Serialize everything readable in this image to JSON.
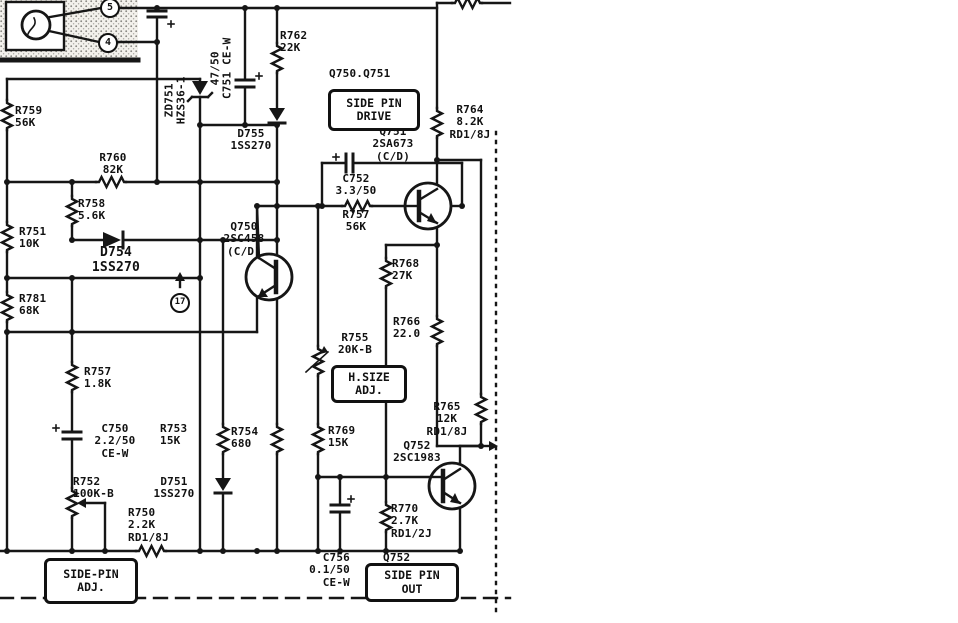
{
  "labels": {
    "r759": "R759\n56K",
    "r760": "R760\n82K",
    "r758": "R758\n5.6K",
    "r751": "R751\n10K",
    "d754": "D754\n1SS270",
    "r781": "R781\n68K",
    "r757_left": "R757\n1.8K",
    "c750": "C750\n2.2/50\nCE-W",
    "r752": "R752\n100K-B",
    "r750": "R750\n2.2K\nRD1/8J",
    "r753": "R753\n15K",
    "d751": "D751\n1SS270",
    "r754": "R754\n680",
    "r769": "R769\n15K",
    "c756": "C756\n0.1/50\nCE-W",
    "zd751": "ZD751\nHZS36-1",
    "c751": "47/50\nC751 CE-W",
    "r762": "R762\n22K",
    "d755": "D755\n1SS270",
    "q750": "Q750\n2SC458\n(C/D)",
    "q751": "Q751\n2SA673\n(C/D)",
    "r764": "R764\n8.2K\nRD1/8J",
    "c752": "C752\n3.3/50",
    "r757_mid": "R757\n56K",
    "r768": "R768\n27K",
    "r766": "R766\n22.0",
    "r755": "R755\n20K-B",
    "r765": "R765\n12K\nRD1/8J",
    "q752": "Q752\n2SC1983",
    "r770": "R770\n2.7K\nRD1/2J"
  },
  "boxes": {
    "side_pin_drive": {
      "title": "Q750.Q751",
      "text": "SIDE PIN\nDRIVE"
    },
    "h_size": {
      "text": "H.SIZE\nADJ."
    },
    "side_pin_out": {
      "title": "Q752",
      "text": "SIDE PIN\nOUT"
    },
    "side_pin_adj": {
      "text": "SIDE-PIN\nADJ."
    }
  },
  "pins": {
    "pin5": "5",
    "pin4": "4",
    "tp17": "17"
  }
}
